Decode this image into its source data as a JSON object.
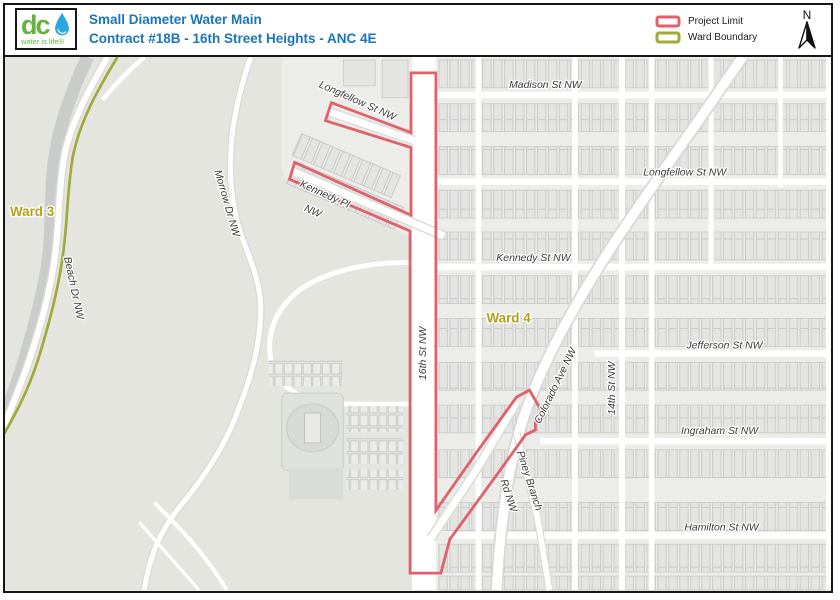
{
  "header": {
    "logo": {
      "abbr": "dc",
      "tagline": "water is life®"
    },
    "title_line1": "Small Diameter Water Main",
    "title_line2": "Contract #18B - 16th Street Heights - ANC 4E",
    "legend": [
      {
        "label": "Project Limit",
        "color": "#e0616a"
      },
      {
        "label": "Ward Boundary",
        "color": "#a2a93a"
      }
    ],
    "north_label": "N"
  },
  "map": {
    "wards": [
      {
        "text": "Ward 3"
      },
      {
        "text": "Ward 4"
      }
    ],
    "streets": [
      {
        "text": "Madison St NW"
      },
      {
        "text": "Longfellow St NW"
      },
      {
        "text": "Kennedy St NW"
      },
      {
        "text": "Jefferson St NW"
      },
      {
        "text": "Ingraham St NW"
      },
      {
        "text": "Hamilton St NW"
      },
      {
        "text": "Longfellow St NW"
      },
      {
        "text": "Kennedy Pl"
      },
      {
        "text": "NW"
      },
      {
        "text": "16th St NW"
      },
      {
        "text": "14th St NW"
      },
      {
        "text": "Colorado Ave NW"
      },
      {
        "text": "Morrow Dr NW"
      },
      {
        "text": "Beach Dr NW"
      },
      {
        "text": "Piney Branch"
      },
      {
        "text": "Rd NW"
      }
    ],
    "colors": {
      "project_limit": "#e0616a",
      "ward_boundary": "#a2a93a",
      "ward_label": "#b1a21c",
      "road": "#ffffff",
      "park": "#e3e5de",
      "urban": "#ecece9",
      "water": "#c9cccb"
    }
  }
}
